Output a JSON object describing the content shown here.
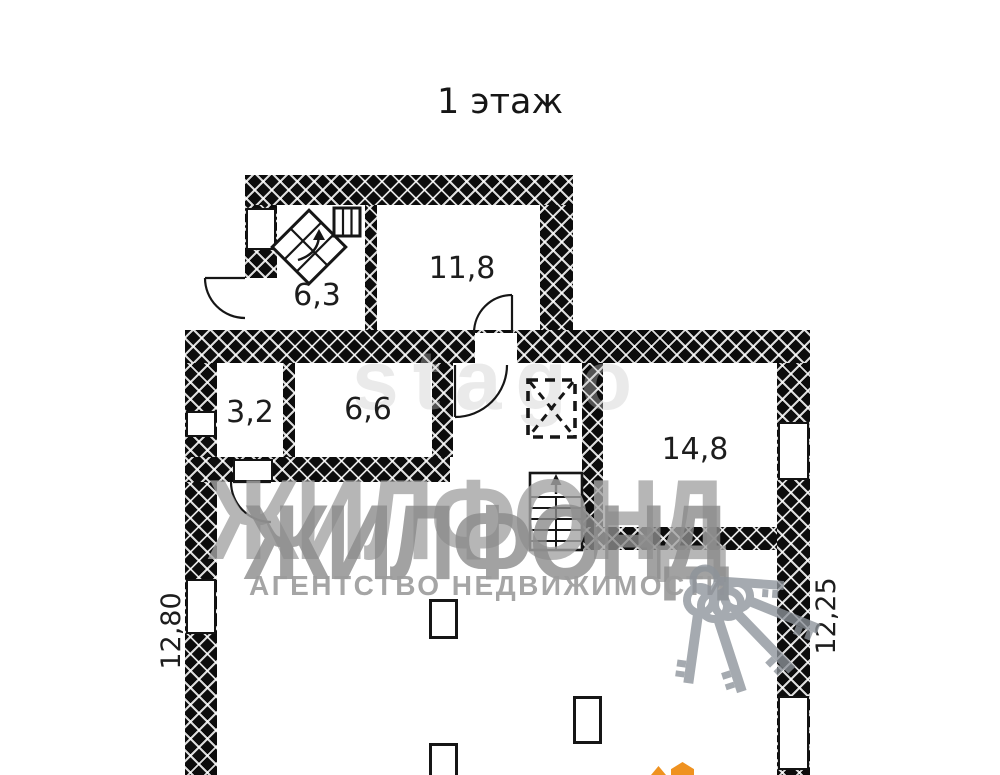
{
  "title": "1 этаж",
  "plan": {
    "rooms": [
      {
        "label": "6,3"
      },
      {
        "label": "11,8"
      },
      {
        "label": "3,2"
      },
      {
        "label": "6,6"
      },
      {
        "label": "14,8"
      }
    ],
    "dimensions": {
      "left": "12,80",
      "right": "12,25"
    }
  },
  "watermark": {
    "brand": "ЖИЛФОНД",
    "subtitle": "АГЕНТСТВО НЕДВИЖИМОСТИ",
    "photo_service": "stago"
  },
  "icons": [
    "stairs-up-icon",
    "staircase-icon",
    "ventilation-shaft-icon",
    "door-arc-icon",
    "keys-watermark-icon"
  ],
  "colors": {
    "wall_black": "#0c0c0c",
    "line_black": "#161616",
    "watermark_gray": "#9b9b9b",
    "agency_gray": "#9c9c9c",
    "photo_gray": "#c9c9c9",
    "orange": "#ef9220"
  }
}
